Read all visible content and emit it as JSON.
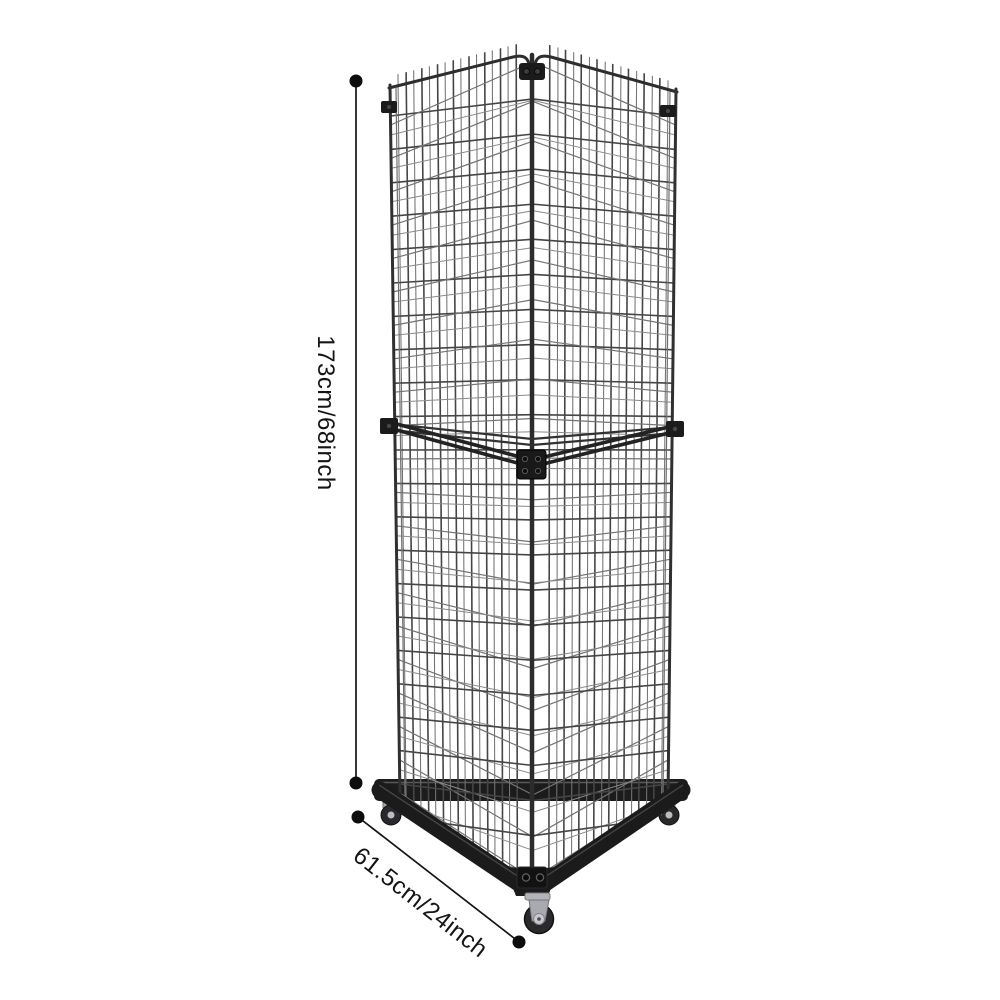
{
  "dimensions": {
    "height_label": "173cm/68inch",
    "base_label": "61.5cm/24inch"
  },
  "colors": {
    "background": "#ffffff",
    "frame": "#1c1c1c",
    "wire_front": "#454545",
    "wire_rear": "#737373",
    "wire_faint": "#8a8a8a",
    "annotation": "#121212",
    "caster_silver": "#b0b0b6"
  }
}
